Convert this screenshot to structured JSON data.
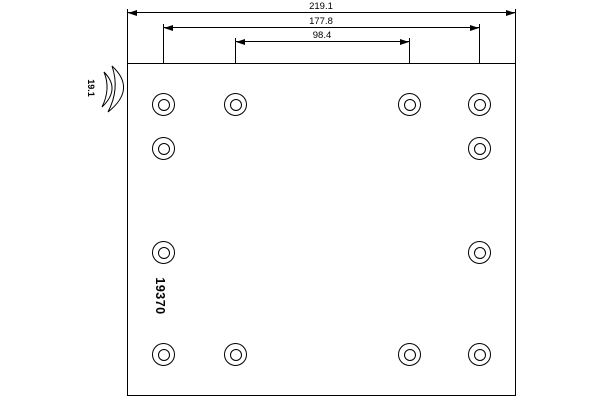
{
  "drawing": {
    "title": "brake-lining rivet hole pattern drawing",
    "part_number": "19370",
    "thickness_label": "19.1",
    "dimensions": [
      {
        "label": "219.1",
        "value": 219.1
      },
      {
        "label": "177.8",
        "value": 177.8
      },
      {
        "label": "98.4",
        "value": 98.4
      }
    ],
    "holes": {
      "count": 12,
      "columns_px": [
        163,
        235,
        409,
        479
      ],
      "rows": [
        {
          "y_px": 104,
          "cols": [
            0,
            1,
            2,
            3
          ]
        },
        {
          "y_px": 148,
          "cols": [
            0,
            3
          ]
        },
        {
          "y_px": 252,
          "cols": [
            0,
            3
          ]
        },
        {
          "y_px": 354,
          "cols": [
            0,
            1,
            2,
            3
          ]
        }
      ]
    }
  },
  "colors": {
    "line": "#000000",
    "background": "#ffffff"
  }
}
